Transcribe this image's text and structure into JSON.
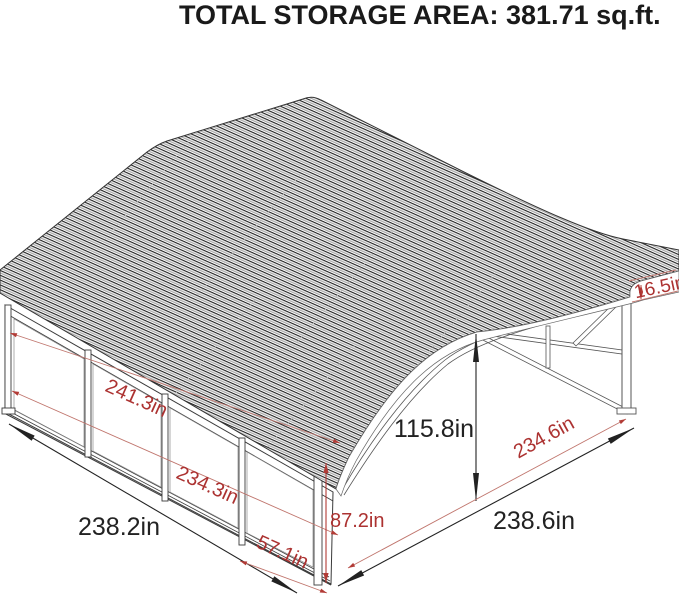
{
  "title": "TOTAL STORAGE AREA: 381.71 sq.ft.",
  "unit": "inches",
  "colors": {
    "dimension_red": "#ac3231",
    "dimension_black": "#222222",
    "structure_line": "#3a3a3a"
  },
  "dimensions": {
    "side_wall_top_length": "241.3in",
    "side_wall_inner_length": "234.3in",
    "end_panel_width": "57.1in",
    "side_wall_overall": "238.2in",
    "corner_height": "87.2in",
    "roof_edge_height": "16.5in",
    "open_side_inner_width": "234.6in",
    "open_side_overall": "238.6in",
    "peak_height": "115.8in"
  }
}
